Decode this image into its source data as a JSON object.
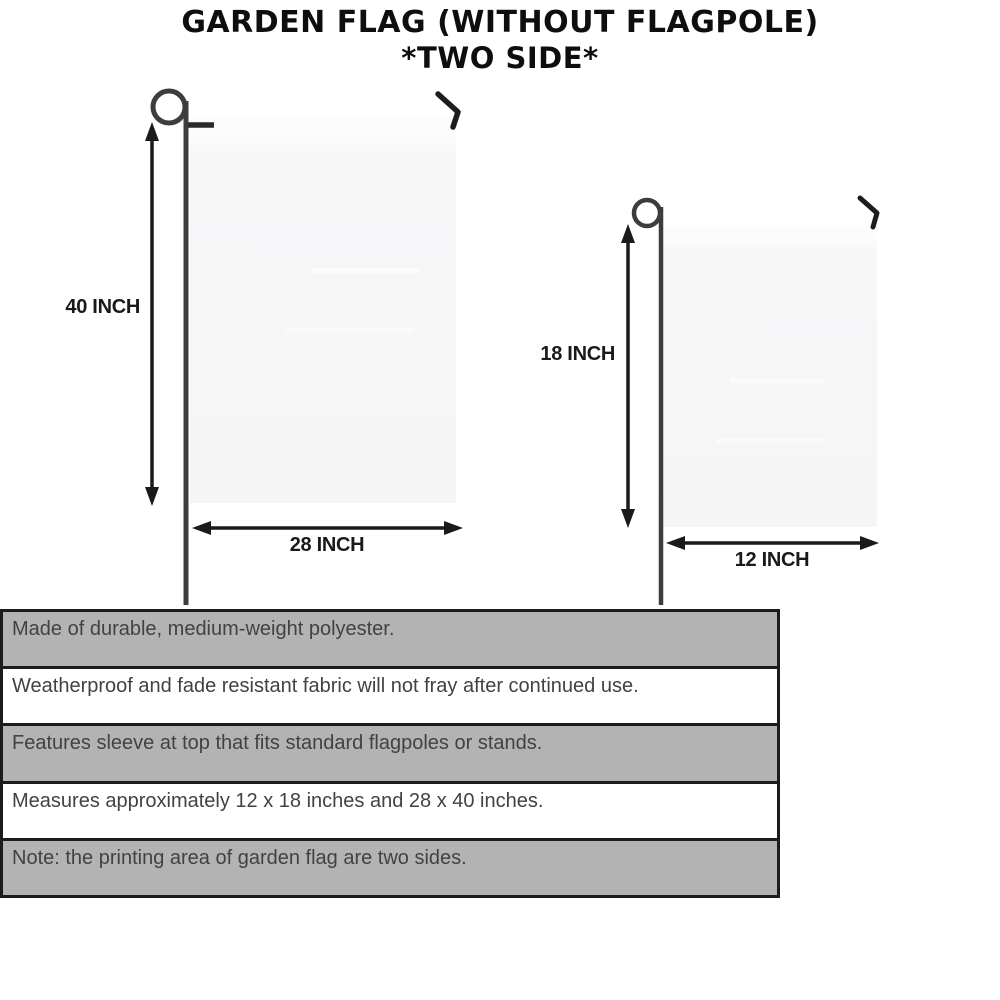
{
  "title": {
    "line1": "GARDEN FLAG (WITHOUT FLAGPOLE)",
    "line2": "*TWO SIDE*"
  },
  "diagram": {
    "large_flag": {
      "height_label": "40 INCH",
      "width_label": "28 INCH"
    },
    "small_flag": {
      "height_label": "18 INCH",
      "width_label": "12 INCH"
    }
  },
  "features": {
    "rows": [
      "Made of durable, medium-weight polyester.",
      "Weatherproof and fade resistant fabric will not fray after continued use.",
      "Features sleeve at top that fits standard flagpoles or stands.",
      "Measures approximately 12 x 18 inches and 28 x 40 inches.",
      "Note: the printing area of garden flag are two sides."
    ]
  },
  "colors": {
    "row_gray": "#b3b3b3",
    "row_white": "#ffffff",
    "border": "#1c1c1c",
    "row_text": "#424242",
    "title_text": "#0e0e0e",
    "flag_fill": "#f6f6f7",
    "pole": "#3d3d3d",
    "arrow": "#1a1a1a"
  }
}
